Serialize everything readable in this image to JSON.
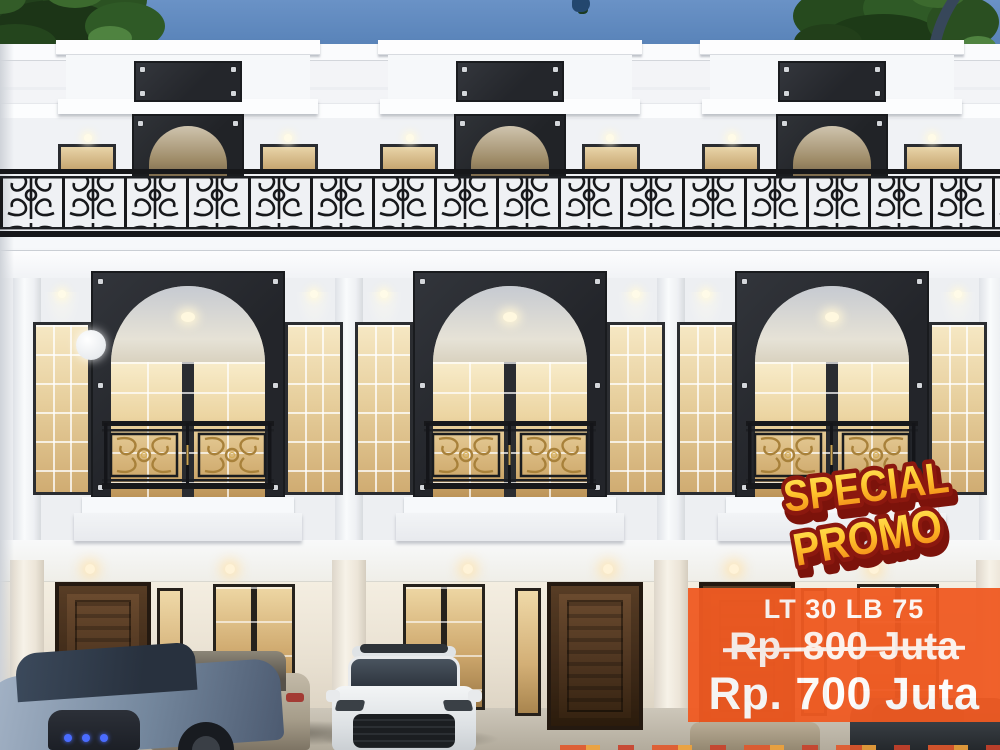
{
  "flyer": {
    "promo_sticker": {
      "line1": "SPECIAL",
      "line2": "PROMO"
    },
    "price_panel": {
      "spec": "LT 30 LB 75",
      "old_price": "Rp. 800 Juta",
      "new_price": "Rp. 700 Juta"
    }
  },
  "colors": {
    "sky_blue": "#5e88bd",
    "facade_white": "#f0f2f5",
    "cornice_white": "#fcfdfe",
    "panel_black": "#26282d",
    "railing_black": "#17181b",
    "window_warm": "#eed9ac",
    "window_warm_deep": "#caa468",
    "door_brown": "#4e3622",
    "promo_orange": "#f05a22",
    "sticker_yellow": "#ffc62e",
    "sticker_orange": "#f07d12",
    "sticker_outline": "#8b180f",
    "text_white": "#ffffff"
  }
}
